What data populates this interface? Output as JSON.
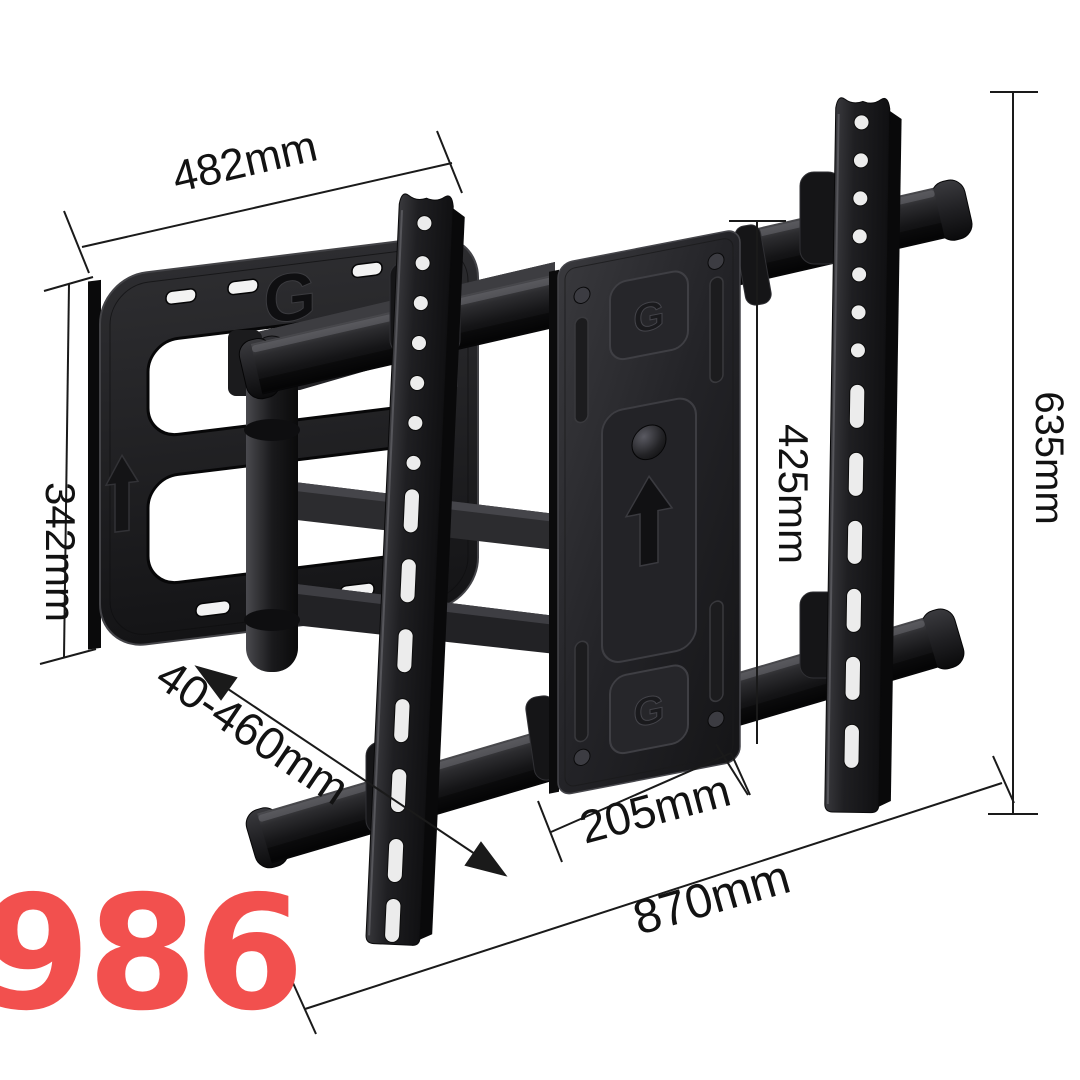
{
  "scene": {
    "background_color": "#ffffff",
    "description": "Articulating full-motion TV wall mount bracket shown in perspective with dimension callouts"
  },
  "product": {
    "model_number": "986",
    "model_number_color": "#f2504e",
    "logo_letter": "G",
    "metal_color_dark": "#18181a",
    "metal_color_mid": "#2b2b2e",
    "metal_highlight": "#55555a"
  },
  "annotations": {
    "line_color": "#1a1a1a",
    "text_color": "#121212",
    "width_top": {
      "label": "482mm"
    },
    "height_left": {
      "label": "342mm"
    },
    "extension_range": {
      "label": "40-460mm"
    },
    "vesa_height": {
      "label": "425mm"
    },
    "rail_height": {
      "label": "635mm"
    },
    "vesa_width": {
      "label": "205mm"
    },
    "total_width": {
      "label": "870mm"
    }
  }
}
